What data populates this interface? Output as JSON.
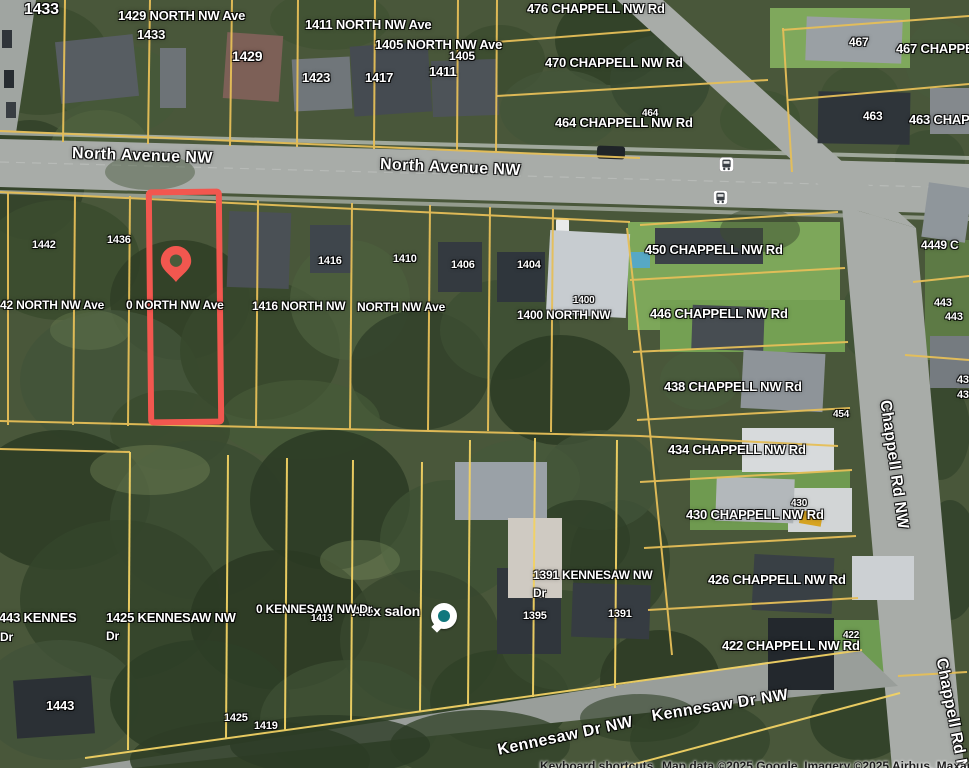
{
  "map": {
    "colors": {
      "highlight_red": "#f2574f",
      "parcel_line_yellow": "#e6bf58",
      "road_gray": "#a8aca8",
      "poi_teal": "#11777d"
    },
    "street_labels": [
      {
        "text": "North Avenue NW",
        "x": 72,
        "y": 146,
        "rot": 2,
        "size": 16
      },
      {
        "text": "North Avenue NW",
        "x": 380,
        "y": 157,
        "rot": 2.5,
        "size": 16
      },
      {
        "text": "Chappell Rd NW",
        "x": 884,
        "y": 392,
        "rot": 82,
        "size": 16
      },
      {
        "text": "Kennesaw Dr NW",
        "x": 498,
        "y": 743,
        "rot": -12,
        "size": 16
      },
      {
        "text": "Kennesaw Dr NW",
        "x": 652,
        "y": 709,
        "rot": -9,
        "size": 16
      },
      {
        "text": "Chappell Rd NW",
        "x": 940,
        "y": 650,
        "rot": 79,
        "size": 16
      }
    ],
    "address_labels": [
      {
        "text": "1433",
        "x": 24,
        "y": 2,
        "size": 16
      },
      {
        "text": "1429 NORTH NW Ave",
        "x": 118,
        "y": 9,
        "size": 13
      },
      {
        "text": "1433",
        "x": 137,
        "y": 28,
        "size": 13
      },
      {
        "text": "1429",
        "x": 232,
        "y": 49,
        "size": 14
      },
      {
        "text": "1411 NORTH NW Ave",
        "x": 305,
        "y": 18,
        "size": 13
      },
      {
        "text": "1405 NORTH NW Ave",
        "x": 375,
        "y": 38,
        "size": 13
      },
      {
        "text": "1405",
        "x": 449,
        "y": 50,
        "size": 12
      },
      {
        "text": "1423",
        "x": 302,
        "y": 71,
        "size": 13
      },
      {
        "text": "1417",
        "x": 365,
        "y": 71,
        "size": 13
      },
      {
        "text": "1411",
        "x": 429,
        "y": 65,
        "size": 13
      },
      {
        "text": "476 CHAPPELL NW Rd",
        "x": 527,
        "y": 2,
        "size": 13
      },
      {
        "text": "470 CHAPPELL NW Rd",
        "x": 545,
        "y": 56,
        "size": 13
      },
      {
        "text": "464",
        "x": 642,
        "y": 109,
        "size": 10
      },
      {
        "text": "464 CHAPPELL NW Rd",
        "x": 555,
        "y": 116,
        "size": 13
      },
      {
        "text": "467",
        "x": 849,
        "y": 36,
        "size": 12
      },
      {
        "text": "467 CHAPPELL NW Rd",
        "x": 896,
        "y": 42,
        "size": 13
      },
      {
        "text": "463",
        "x": 863,
        "y": 110,
        "size": 12
      },
      {
        "text": "463 CHAPPELL NW Rd",
        "x": 909,
        "y": 113,
        "size": 13
      },
      {
        "text": "1442",
        "x": 32,
        "y": 240,
        "size": 11
      },
      {
        "text": "1436",
        "x": 107,
        "y": 235,
        "size": 11
      },
      {
        "text": "42 NORTH NW Ave",
        "x": 0,
        "y": 299,
        "size": 12
      },
      {
        "text": "0 NORTH NW Ave",
        "x": 126,
        "y": 299,
        "size": 12
      },
      {
        "text": "1416 NORTH NW",
        "x": 252,
        "y": 300,
        "size": 12
      },
      {
        "text": "NORTH NW Ave",
        "x": 357,
        "y": 301,
        "size": 12
      },
      {
        "text": "1400 NORTH NW",
        "x": 517,
        "y": 309,
        "size": 12
      },
      {
        "text": "1400",
        "x": 573,
        "y": 296,
        "size": 10
      },
      {
        "text": "1416",
        "x": 318,
        "y": 256,
        "size": 11
      },
      {
        "text": "1410",
        "x": 393,
        "y": 254,
        "size": 11
      },
      {
        "text": "1406",
        "x": 451,
        "y": 260,
        "size": 11
      },
      {
        "text": "1404",
        "x": 517,
        "y": 260,
        "size": 11
      },
      {
        "text": "450 CHAPPELL NW Rd",
        "x": 645,
        "y": 243,
        "size": 13
      },
      {
        "text": "4449 C",
        "x": 921,
        "y": 239,
        "size": 12
      },
      {
        "text": "443",
        "x": 934,
        "y": 298,
        "size": 11
      },
      {
        "text": "443",
        "x": 945,
        "y": 312,
        "size": 11
      },
      {
        "text": "446 CHAPPELL NW Rd",
        "x": 650,
        "y": 307,
        "size": 13
      },
      {
        "text": "438 CHAPPELL NW Rd",
        "x": 664,
        "y": 380,
        "size": 13
      },
      {
        "text": "454",
        "x": 833,
        "y": 410,
        "size": 10
      },
      {
        "text": "434 CHAPPELL NW Rd",
        "x": 668,
        "y": 443,
        "size": 13
      },
      {
        "text": "43",
        "x": 957,
        "y": 375,
        "size": 11
      },
      {
        "text": "43",
        "x": 957,
        "y": 390,
        "size": 11
      },
      {
        "text": "430",
        "x": 791,
        "y": 499,
        "size": 10
      },
      {
        "text": "430 CHAPPELL NW Rd",
        "x": 686,
        "y": 508,
        "size": 13
      },
      {
        "text": "426 CHAPPELL NW Rd",
        "x": 708,
        "y": 573,
        "size": 13
      },
      {
        "text": "1391 KENNESAW NW",
        "x": 533,
        "y": 569,
        "size": 12
      },
      {
        "text": "Dr",
        "x": 533,
        "y": 587,
        "size": 12
      },
      {
        "text": "1395",
        "x": 523,
        "y": 611,
        "size": 11
      },
      {
        "text": "1391",
        "x": 608,
        "y": 609,
        "size": 11
      },
      {
        "text": "0 KENNESAW NW Dr",
        "x": 256,
        "y": 603,
        "size": 12
      },
      {
        "text": "1413",
        "x": 311,
        "y": 614,
        "size": 10
      },
      {
        "text": "1443 KENNES",
        "x": -8,
        "y": 611,
        "size": 13
      },
      {
        "text": "Dr",
        "x": 0,
        "y": 631,
        "size": 12
      },
      {
        "text": "1425 KENNESAW NW",
        "x": 106,
        "y": 611,
        "size": 13
      },
      {
        "text": "Dr",
        "x": 106,
        "y": 630,
        "size": 12
      },
      {
        "text": "1443",
        "x": 46,
        "y": 699,
        "size": 13
      },
      {
        "text": "1425",
        "x": 224,
        "y": 713,
        "size": 11
      },
      {
        "text": "1419",
        "x": 254,
        "y": 721,
        "size": 11
      },
      {
        "text": "422",
        "x": 843,
        "y": 631,
        "size": 10
      },
      {
        "text": "422 CHAPPELL NW Rd",
        "x": 722,
        "y": 639,
        "size": 13
      }
    ],
    "poi": {
      "label": "Alex salon"
    },
    "icons": [
      "location-pin-icon",
      "bus-stop-icon",
      "bus-stop-icon",
      "poi-icon"
    ],
    "attribution": {
      "shortcuts": "Keyboard shortcuts",
      "map_data": "Map data ©2025 Google  Imagery ©2025 Airbus, Maxar Tech"
    }
  }
}
